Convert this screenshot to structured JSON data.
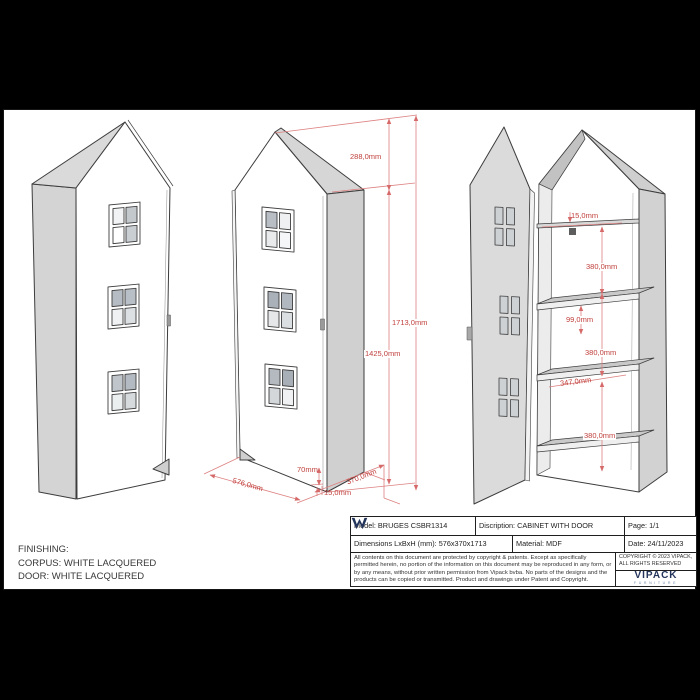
{
  "finishing": {
    "line1": "FINISHING:",
    "line2": "CORPUS: WHITE LACQUERED",
    "line3": "DOOR: WHITE LACQUERED"
  },
  "title_block": {
    "model": "Model: BRUGES CSBR1314",
    "description": "Discription: CABINET WITH DOOR",
    "page": "Page: 1/1",
    "dimensions": "Dimensions LxBxH (mm): 576x370x1713",
    "material": "Material: MDF",
    "date": "Date: 24/11/2023",
    "legal": "All contents on this document are protected by copyright & patents. Except as specifically permitted herein, no portion of the information on this document may be reproduced in any form, or by any means, without prior written permission from Vipack bvba. No parts of the designs and the products can be copied or transmitted. Product and drawings under Patent and Copyright.",
    "copyright": "COPYRIGHT © 2023 VIPACK, ALL RIGHTS RESERVED",
    "brand_name": "VIPACK",
    "brand_subtitle": "FURNITURE"
  },
  "dimensions": {
    "roof_height": "288,0mm",
    "total_height": "1713,0mm",
    "body_height": "1425,0mm",
    "plinth_height": "70mm",
    "width": "576,0mm",
    "door_thickness": "15,0mm",
    "depth": "370,0mm",
    "shelf_thickness": "15,0mm",
    "top_section": "380,0mm",
    "shelf_section": "99,0mm",
    "middle_section": "380,0mm",
    "shelf_depth": "347,0mm",
    "bottom_section": "380,0mm"
  },
  "colors": {
    "dimension_red": "#c0403c",
    "brand_navy": "#24355c",
    "panel_gray": "#d2d2d2"
  }
}
